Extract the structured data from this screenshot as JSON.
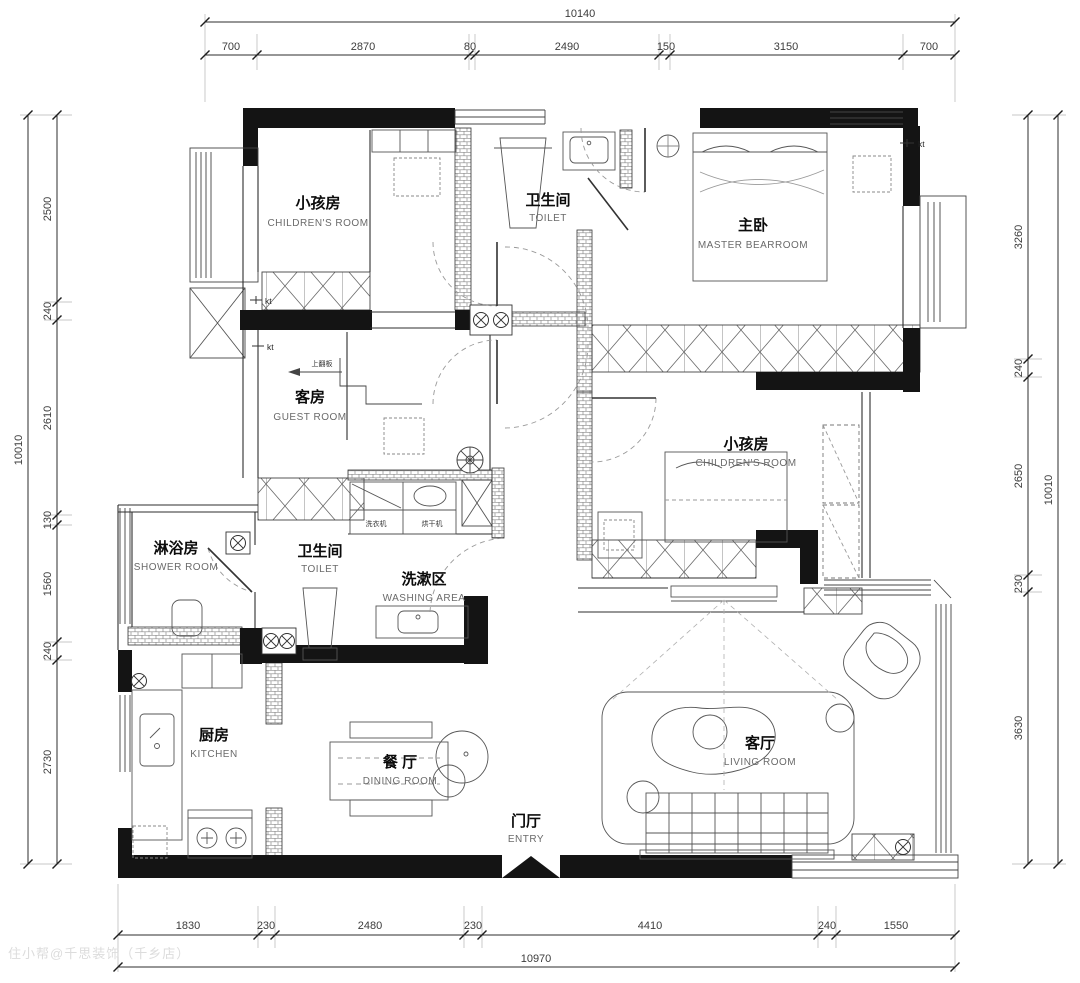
{
  "watermark": "住小帮@千思装饰（千乡店）",
  "dims": {
    "top": {
      "total": "10140",
      "segments": [
        "700",
        "2870",
        "80",
        "2490",
        "150",
        "3150",
        "700"
      ]
    },
    "bottom": {
      "total": "10970",
      "segments": [
        "1830",
        "230",
        "2480",
        "230",
        "4410",
        "240",
        "1550"
      ]
    },
    "left": {
      "total": "10010",
      "segments": [
        "2500",
        "240",
        "2610",
        "130",
        "1560",
        "240",
        "2730"
      ]
    },
    "right": {
      "total": "10010",
      "segments": [
        "3260",
        "240",
        "2650",
        "230",
        "3630"
      ]
    }
  },
  "rooms": {
    "children_top": {
      "zh": "小孩房",
      "en": "CHILDREN'S ROOM"
    },
    "toilet_top": {
      "zh": "卫生间",
      "en": "TOILET"
    },
    "master": {
      "zh": "主卧",
      "en": "MASTER BEARROOM"
    },
    "guest": {
      "zh": "客房",
      "en": "GUEST ROOM"
    },
    "children_right": {
      "zh": "小孩房",
      "en": "CHILDREN'S ROOM"
    },
    "shower": {
      "zh": "淋浴房",
      "en": "SHOWER ROOM"
    },
    "toilet_mid": {
      "zh": "卫生间",
      "en": "TOILET"
    },
    "washing": {
      "zh": "洗漱区",
      "en": "WASHING AREA"
    },
    "kitchen": {
      "zh": "厨房",
      "en": "KITCHEN"
    },
    "dining": {
      "zh": "餐 厅",
      "en": "DINING ROOM"
    },
    "entry": {
      "zh": "门厅",
      "en": "ENTRY"
    },
    "living": {
      "zh": "客厅",
      "en": "LIVING ROOM"
    }
  },
  "annotations": {
    "ac_unit": "kt",
    "washer": "洗衣机",
    "dryer": "烘干机",
    "flip": "上翻板"
  }
}
